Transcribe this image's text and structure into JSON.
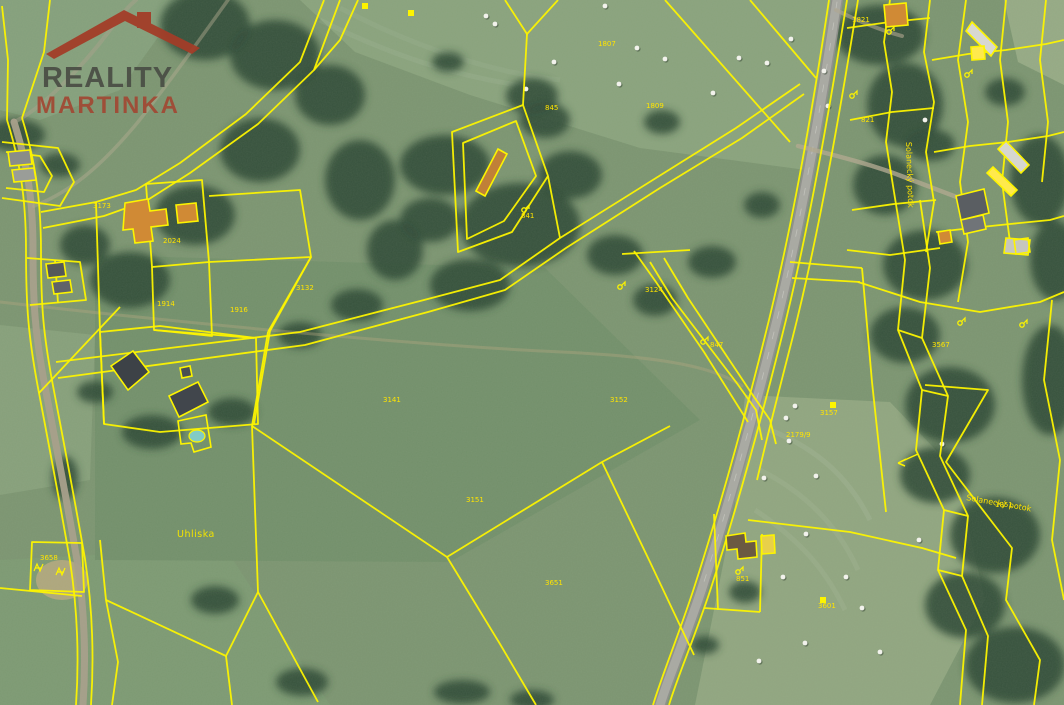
{
  "logo": {
    "line1": "REALITY",
    "line2": "MARTINKA",
    "line1_color": "#4b4f46",
    "line2_color": "#a04a35",
    "roof_color": "#a23d28"
  },
  "map": {
    "colors": {
      "parcel_line": "#fdf400",
      "building_fill": "#d08a35",
      "forest": "#2e4a37",
      "field_base": "#7c9571",
      "road": "#a3a39d",
      "water_pool": "#82cbc4",
      "hay_bale": "#f2f2ec",
      "label": "#ffe400"
    }
  },
  "labels": {
    "place": {
      "text": "Uhliska",
      "x": 177,
      "y": 537
    },
    "stream_diagonal": {
      "text": "Solanecký potok",
      "x": 966,
      "y": 500,
      "rotate": 10
    },
    "stream_vertical": {
      "text": "Solanecký potok",
      "x": 906,
      "y": 142,
      "rotate": 88
    },
    "parcel_numbers": [
      {
        "x": 598,
        "y": 46,
        "t": "1807"
      },
      {
        "x": 93,
        "y": 208,
        "t": "3173"
      },
      {
        "x": 163,
        "y": 243,
        "t": "2024"
      },
      {
        "x": 157,
        "y": 306,
        "t": "1914"
      },
      {
        "x": 296,
        "y": 290,
        "t": "3132"
      },
      {
        "x": 383,
        "y": 402,
        "t": "3141"
      },
      {
        "x": 466,
        "y": 502,
        "t": "3151"
      },
      {
        "x": 610,
        "y": 402,
        "t": "3152"
      },
      {
        "x": 645,
        "y": 292,
        "t": "3124"
      },
      {
        "x": 710,
        "y": 347,
        "t": "847"
      },
      {
        "x": 521,
        "y": 218,
        "t": "841"
      },
      {
        "x": 820,
        "y": 415,
        "t": "3157"
      },
      {
        "x": 786,
        "y": 437,
        "t": "2179/9"
      },
      {
        "x": 932,
        "y": 347,
        "t": "3567"
      },
      {
        "x": 995,
        "y": 507,
        "t": "1851"
      },
      {
        "x": 861,
        "y": 122,
        "t": "821"
      },
      {
        "x": 852,
        "y": 22,
        "t": "1821"
      },
      {
        "x": 818,
        "y": 608,
        "t": "3601"
      },
      {
        "x": 545,
        "y": 110,
        "t": "845"
      },
      {
        "x": 230,
        "y": 312,
        "t": "1916"
      },
      {
        "x": 646,
        "y": 108,
        "t": "1809"
      },
      {
        "x": 736,
        "y": 581,
        "t": "851"
      },
      {
        "x": 40,
        "y": 560,
        "t": "3658"
      },
      {
        "x": 545,
        "y": 585,
        "t": "3651"
      }
    ]
  },
  "geometry": {
    "terrain": [
      {
        "type": "poly",
        "pts": "0,0 185,0 120,90 40,120 0,110",
        "fill": "#85a07c",
        "op": 1
      },
      {
        "type": "poly",
        "pts": "300,0 840,0 806,170 640,148 470,95 355,52",
        "fill": "#8aa37d",
        "op": 1
      },
      {
        "type": "poly",
        "pts": "1004,0 1064,0 1064,85 1018,62",
        "fill": "#96aa85",
        "op": 1
      },
      {
        "type": "poly",
        "pts": "745,395 890,402 955,470 985,600 930,705 695,705 735,505",
        "fill": "#91a680",
        "op": 1
      },
      {
        "type": "poly",
        "pts": "0,325 95,335 90,480 0,495",
        "fill": "#87a07b",
        "op": 1
      },
      {
        "type": "poly",
        "pts": "0,560 225,548 330,705 0,705",
        "fill": "#7d9a73",
        "op": 1
      },
      {
        "type": "poly",
        "pts": "95,255 545,268 700,420 450,562 95,560",
        "fill": "#73906b",
        "op": 1
      },
      {
        "type": "ellipse",
        "cx": 62,
        "cy": 580,
        "rx": 26,
        "ry": 20,
        "fill": "#b5a87e",
        "op": 0.9
      }
    ],
    "forest": [
      [
        205,
        25,
        45,
        35
      ],
      [
        275,
        55,
        45,
        35
      ],
      [
        330,
        95,
        35,
        30
      ],
      [
        260,
        150,
        40,
        32
      ],
      [
        195,
        215,
        40,
        30
      ],
      [
        130,
        280,
        40,
        28
      ],
      [
        85,
        245,
        25,
        20
      ],
      [
        15,
        135,
        30,
        16
      ],
      [
        60,
        165,
        20,
        12
      ],
      [
        445,
        165,
        45,
        30
      ],
      [
        520,
        225,
        60,
        42
      ],
      [
        470,
        285,
        40,
        26
      ],
      [
        570,
        175,
        32,
        24
      ],
      [
        615,
        255,
        28,
        20
      ],
      [
        655,
        300,
        22,
        16
      ],
      [
        545,
        120,
        25,
        18
      ],
      [
        430,
        220,
        30,
        22
      ],
      [
        360,
        180,
        35,
        40
      ],
      [
        395,
        250,
        28,
        30
      ],
      [
        357,
        305,
        26,
        16
      ],
      [
        300,
        335,
        22,
        13
      ],
      [
        880,
        35,
        45,
        30
      ],
      [
        905,
        105,
        38,
        42
      ],
      [
        885,
        185,
        32,
        30
      ],
      [
        925,
        265,
        42,
        35
      ],
      [
        905,
        335,
        35,
        28
      ],
      [
        950,
        405,
        45,
        38
      ],
      [
        935,
        475,
        35,
        28
      ],
      [
        995,
        535,
        45,
        38
      ],
      [
        965,
        605,
        40,
        33
      ],
      [
        1015,
        665,
        50,
        38
      ],
      [
        1050,
        380,
        28,
        55
      ],
      [
        1040,
        180,
        30,
        45
      ],
      [
        1055,
        260,
        25,
        40
      ],
      [
        930,
        145,
        25,
        16
      ],
      [
        1005,
        92,
        20,
        14
      ],
      [
        215,
        600,
        24,
        14
      ],
      [
        302,
        682,
        26,
        14
      ],
      [
        462,
        692,
        28,
        12
      ],
      [
        532,
        700,
        22,
        10
      ],
      [
        745,
        592,
        16,
        11
      ],
      [
        705,
        645,
        14,
        9
      ],
      [
        532,
        96,
        26,
        18
      ],
      [
        448,
        62,
        16,
        10
      ],
      [
        662,
        122,
        18,
        12
      ],
      [
        712,
        262,
        24,
        16
      ],
      [
        762,
        205,
        18,
        13
      ],
      [
        152,
        432,
        30,
        17
      ],
      [
        232,
        412,
        24,
        14
      ],
      [
        95,
        392,
        18,
        11
      ],
      [
        65,
        478,
        13,
        22
      ]
    ],
    "roads": [
      {
        "d": "M837,0 C822,100 800,230 772,340 C750,428 724,520 702,588 C687,634 668,678 660,705",
        "c": "#8f8f8b",
        "w": 12,
        "o": 1
      },
      {
        "d": "M837,0 C822,100 800,230 772,340 C750,428 724,520 702,588 C687,634 668,678 660,705",
        "c": "#a9a9a3",
        "w": 9,
        "o": 1
      },
      {
        "d": "M837,2 C822,100 800,230 772,340 C750,428 724,520 702,588",
        "c": "#c9c9c3",
        "w": 0.8,
        "o": 0.8,
        "dash": "7 14"
      },
      {
        "d": "M14,122 C26,160 33,195 33,250 C33,305 35,335 46,392 C57,450 67,502 77,560 C85,612 86,660 83,705",
        "c": "#a89f8a",
        "w": 7,
        "o": 0.95
      },
      {
        "d": "M14,122 C40,110 80,70 110,30 C125,10 130,5 136,0",
        "c": "#a89f8a",
        "w": 4,
        "o": 0.5
      },
      {
        "d": "M798,146 C846,158 876,166 904,177 C936,189 958,198 982,206",
        "c": "#b0a78f",
        "w": 4.5,
        "o": 0.8
      },
      {
        "d": "M836,10 C860,22 880,30 902,36",
        "c": "#b0a78f",
        "w": 4,
        "o": 0.6
      },
      {
        "d": "M0,302 C210,326 430,346 562,352 C668,357 716,368 742,386",
        "c": "#b1a67e",
        "w": 3,
        "o": 0.4
      },
      {
        "d": "M228,0 C198,42 168,84 138,122 C108,158 76,190 34,206",
        "c": "#b3ab90",
        "w": 3.5,
        "o": 0.45
      }
    ],
    "parcel_lines": [
      "M2,6 L8,60 L7,120",
      "M22,118 L44,52 L50,0",
      "M7,120 C19,158 26,195 26,250 C26,305 28,336 39,393 C50,451 60,503 70,561 C78,613 79,661 76,705",
      "M22,118 C34,156 41,196 41,251 C41,306 43,334 54,391 C65,449 75,501 85,559 C93,611 94,659 91,705",
      "M2,142 L58,148 L74,182 L60,206 L2,198",
      "M6,152 L40,156 L52,176 L44,192 L6,188",
      "M27,258 L80,262 L86,300 L30,305",
      "M55,260 L58,303",
      "M41,212 L96,202 L136,190 L180,163 L246,114 L300,62 L324,0",
      "M43,228 L104,216 L146,201 L190,173 L258,124 L314,70 L340,0",
      "M358,0 L340,40 L314,70",
      "M146,184 L202,180 L209,262 L152,267 Z",
      "M209,196 L300,190 L311,257 L209,262",
      "M152,267 L154,330 L212,336 L209,262",
      "M311,257 L270,331 L254,424",
      "M154,330 L254,338",
      "M96,202 L100,332 L104,424",
      "M39,393 L120,307",
      "M100,332 L160,326 L256,338 L258,424 L160,432 L104,424 Z",
      "M505,0 L527,34 L558,0",
      "M527,34 L523,105",
      "M452,132 L523,105 L548,176 L512,232 L458,252 Z",
      "M463,143 L516,121 L536,176 L504,221 L467,239 Z",
      "M548,176 L560,238",
      "M665,0 L790,142",
      "M750,0 L816,78",
      "M56,362 L300,332 L424,300 L500,280 L560,238 L656,178 L736,128 L800,84",
      "M58,378 L305,345 L428,312 L505,290 L566,248 L660,188 L742,138 L804,94",
      "M622,254 L690,250",
      "M634,251 L656,282 L704,352 L748,422",
      "M650,262 L672,298 L736,382 L756,410 L762,440",
      "M664,258 L688,298 L752,394 L770,420 L776,444",
      "M790,262 L862,268",
      "M792,278 L860,282",
      "M862,268 L872,382 L886,512",
      "M829,0 C814,100 792,230 764,340 C742,428 716,520 694,588 C679,634 661,678 653,705",
      "M847,0 C831,100 809,230 781,340 C759,428 733,520 711,588 C696,634 677,678 669,705",
      "M858,0 C842,100 820,230 792,340 C776,402 764,450 757,480",
      "M748,520 L850,532 L922,548 L956,558",
      "M714,514 L718,610",
      "M704,608 L760,612",
      "M762,534 L760,612",
      "M252,426 L447,557 L602,462 L670,426",
      "M252,426 L268,332",
      "M268,332 L311,257",
      "M447,557 L500,644 L536,705",
      "M602,462 L650,562 L694,655",
      "M0,588 L82,596",
      "M32,542 L82,543 L84,592 L30,590 Z",
      "M100,540 L106,600 L118,662 L112,705",
      "M106,600 L226,656 L258,592 L252,426",
      "M226,656 L232,705",
      "M258,592 L318,702",
      "M890,0 L884,42 L892,92 L886,142 L894,192",
      "M930,0 L924,52 L934,102 L926,152 L934,202 L926,252",
      "M847,28 L890,22 L930,18",
      "M850,120 L892,112 L934,108",
      "M852,210 L894,204 L936,200",
      "M847,250 L890,255 L940,248",
      "M966,0 L958,60 L968,122 L960,182 L968,242 L958,302",
      "M1006,0 L1000,60 L1008,122 L1002,182 L1010,242",
      "M1046,0 L1040,60 L1048,122 L1042,182",
      "M932,60 L968,54 L1006,50 L1046,44 L1064,40",
      "M934,152 L970,146 L1008,142 L1048,136 L1064,132",
      "M936,232 L972,228 L1010,224 L1050,220 L1064,216",
      "M858,282 L920,302 L980,312 L1040,302 L1064,292",
      "M894,192 L905,260 L898,330 L922,390 L916,450 L944,510 L938,570 L966,630 L960,705",
      "M920,200 L930,268 L922,338 L948,396 L940,456 L968,516 L962,576 L988,636 L982,705",
      "M925,385 L988,390 L946,462 L1012,548 L1006,600 L1040,660 L1034,705",
      "M1052,300 L1044,380 L1060,460 L1052,540 L1064,600",
      "M898,330 L922,338",
      "M922,390 L948,396",
      "M944,510 L968,516",
      "M938,570 L962,576"
    ],
    "buildings": [
      {
        "pts": "125,203 148,199 150,211 166,209 168,225 151,227 153,241 135,243 133,229 123,230",
        "fill": "#d08a35"
      },
      {
        "pts": "176,205 196,203 198,221 178,223",
        "fill": "#d08a35"
      },
      {
        "pts": "8,152 30,150 32,164 10,166",
        "fill": "#8a8d88"
      },
      {
        "pts": "12,170 34,168 36,180 14,182",
        "fill": "#9a9d98"
      },
      {
        "pts": "46,264 64,262 66,276 48,278",
        "fill": "#55585a"
      },
      {
        "pts": "52,282 70,280 72,292 54,294",
        "fill": "#606368"
      },
      {
        "pts": "111,366 133,351 149,372 128,390",
        "fill": "#3d4247"
      },
      {
        "pts": "169,396 198,382 208,402 179,417",
        "fill": "#41464c"
      },
      {
        "pts": "180,368 190,366 192,376 182,378",
        "fill": "#4a4f52"
      },
      {
        "pts": "178,421 206,415 211,447 194,452 191,443 181,444",
        "fill": "none"
      },
      {
        "pts": "476,191 498,149 507,154 485,196",
        "fill": "#c08038"
      },
      {
        "pts": "726,536 745,533 746,542 756,541 757,557 738,559 737,549 727,550",
        "fill": "#6b5a42"
      },
      {
        "pts": "761,536 774,535 775,553 762,554",
        "fill": "#e8d04a"
      },
      {
        "pts": "956,196 984,189 989,213 961,220",
        "fill": "#5a5e62"
      },
      {
        "pts": "961,220 983,215 986,229 964,234",
        "fill": "#707478"
      },
      {
        "pts": "972,22 997,47 991,56 966,31",
        "fill": "#d8d8d0"
      },
      {
        "pts": "884,5 906,3 908,25 886,27",
        "fill": "#d08a35"
      },
      {
        "pts": "1006,141 1029,165 1021,173 998,149",
        "fill": "#d6d6ce"
      },
      {
        "pts": "993,167 1017,190 1011,196 987,173",
        "fill": "#ffe94d"
      },
      {
        "pts": "971,47 984,46 985,59 972,60",
        "fill": "#ffe94d"
      },
      {
        "pts": "1006,238 1030,240 1028,255 1004,253",
        "fill": "#c6c6be"
      },
      {
        "pts": "938,232 950,230 952,242 940,244",
        "fill": "#d08a35"
      },
      {
        "pts": "1014,240 1028,238 1030,252 1016,254",
        "fill": "none"
      }
    ],
    "pool": {
      "cx": 197,
      "cy": 436,
      "rx": 8,
      "ry": 6
    },
    "bales": [
      [
        486,
        16
      ],
      [
        495,
        24
      ],
      [
        526,
        89
      ],
      [
        554,
        62
      ],
      [
        605,
        6
      ],
      [
        619,
        84
      ],
      [
        637,
        48
      ],
      [
        665,
        59
      ],
      [
        713,
        93
      ],
      [
        739,
        58
      ],
      [
        767,
        63
      ],
      [
        791,
        39
      ],
      [
        824,
        71
      ],
      [
        828,
        106
      ],
      [
        925,
        120
      ],
      [
        795,
        406
      ],
      [
        786,
        418
      ],
      [
        789,
        441
      ],
      [
        816,
        476
      ],
      [
        764,
        478
      ],
      [
        806,
        534
      ],
      [
        764,
        545
      ],
      [
        783,
        577
      ],
      [
        846,
        577
      ],
      [
        805,
        643
      ],
      [
        862,
        608
      ],
      [
        880,
        652
      ],
      [
        919,
        540
      ],
      [
        942,
        444
      ],
      [
        759,
        661
      ]
    ],
    "symbol_squares": [
      [
        362,
        3
      ],
      [
        408,
        10
      ],
      [
        830,
        402
      ],
      [
        820,
        597
      ]
    ],
    "symbol_trees": [
      [
        524,
        210
      ],
      [
        620,
        287
      ],
      [
        703,
        342
      ],
      [
        889,
        32
      ],
      [
        967,
        75
      ],
      [
        738,
        572
      ],
      [
        960,
        323
      ],
      [
        1022,
        325
      ],
      [
        852,
        96
      ]
    ],
    "symbol_w": [
      [
        38,
        568
      ],
      [
        60,
        572
      ]
    ],
    "flow_arrow": "M918,454 L898,463 M898,463 L906,459 M898,463 L905,466"
  }
}
